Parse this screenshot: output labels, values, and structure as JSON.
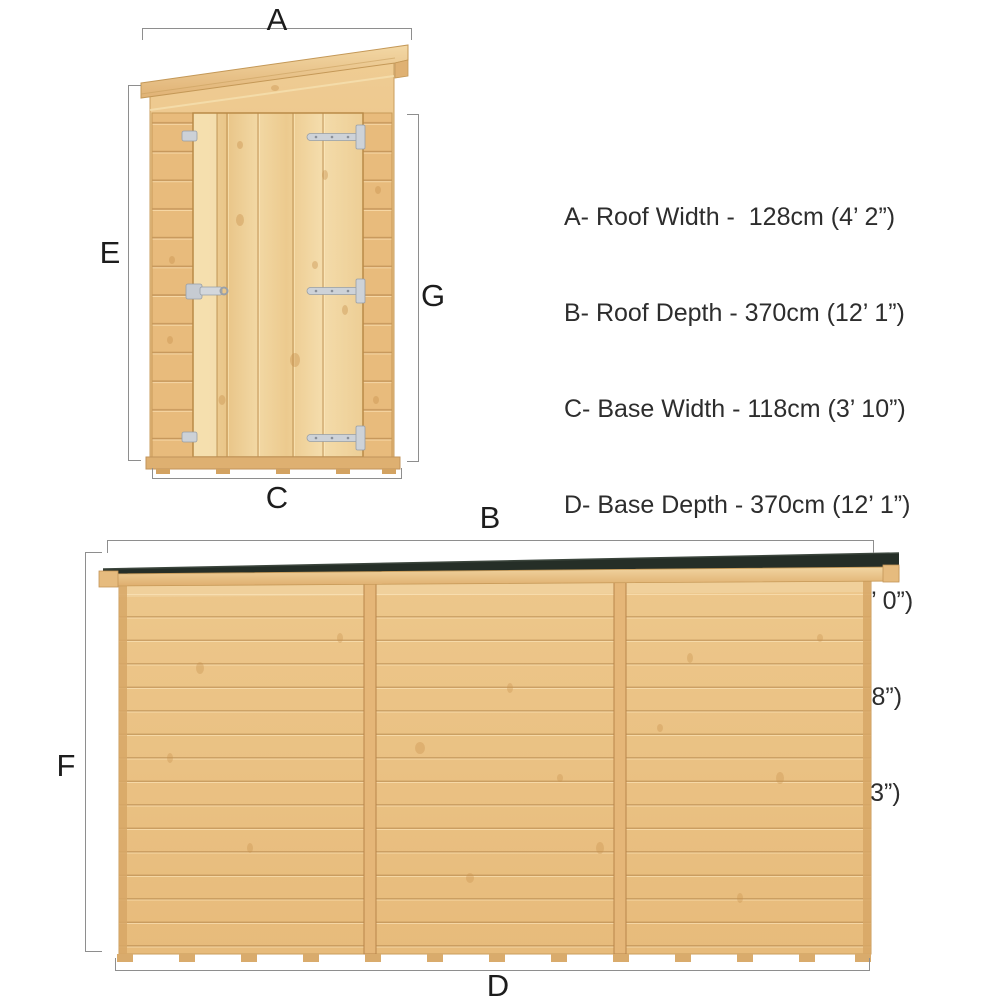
{
  "markers": {
    "roof_width": "A",
    "roof_depth": "B",
    "base_width": "C",
    "base_depth": "D",
    "eaves_height": "E",
    "roof_height": "F",
    "door_height": "G"
  },
  "dimensions": {
    "lines": [
      "A- Roof Width -  128cm (4’ 2”)",
      "B- Roof Depth - 370cm (12’ 1”)",
      "C- Base Width - 118cm (3’ 10”)",
      "D- Base Depth - 370cm (12’ 1”)",
      "E- Eaves Height - 185cm (6’ 0”)",
      "F- Roof Height -  203cm (6’ 8”)",
      "G- Door Height - 161cm (5’ 3”)"
    ]
  },
  "colors": {
    "wood_light": "#f0d29c",
    "wood_mid": "#eac182",
    "wood_dark": "#d7a766",
    "roof_felt": "#252e27",
    "metal_hinge": "#cdd2d8",
    "dimension_line": "#8e8e8e",
    "text": "#2d2d2d"
  }
}
